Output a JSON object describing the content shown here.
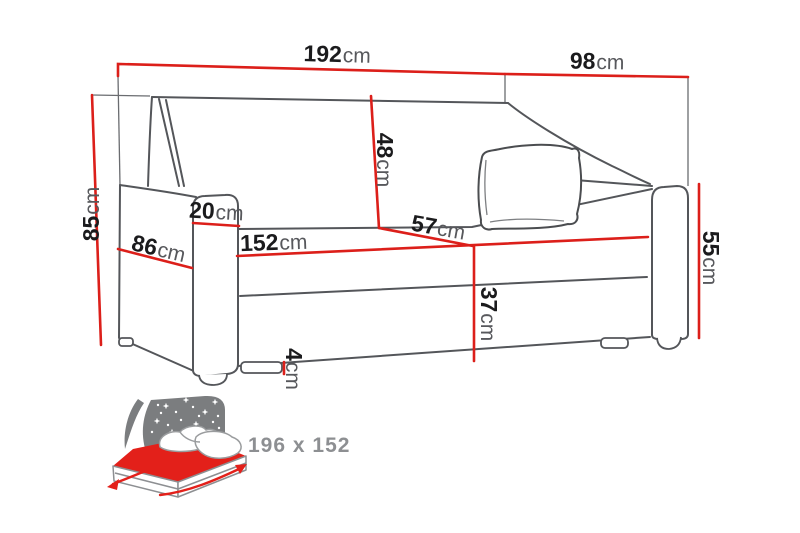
{
  "diagram": {
    "title_hint": "sofa-bed dimension drawing",
    "colors": {
      "dimension_red": "#dc1f1a",
      "outline_gray": "#54565a",
      "number_black": "#1b1b1d",
      "unit_gray": "#57585c",
      "icon_gray": "#7b7d7f",
      "icon_label_gray": "#8d8f92",
      "bed_red": "#e3201a"
    },
    "dims": {
      "width": {
        "value": "192",
        "unit": "cm"
      },
      "depth": {
        "value": "98",
        "unit": "cm"
      },
      "height": {
        "value": "85",
        "unit": "cm"
      },
      "side_depth": {
        "value": "86",
        "unit": "cm"
      },
      "arm_width": {
        "value": "20",
        "unit": "cm"
      },
      "backrest_height": {
        "value": "48",
        "unit": "cm"
      },
      "seat_width": {
        "value": "152",
        "unit": "cm"
      },
      "seat_depth": {
        "value": "57",
        "unit": "cm"
      },
      "arm_height": {
        "value": "55",
        "unit": "cm"
      },
      "seat_height": {
        "value": "37",
        "unit": "cm"
      },
      "leg_height": {
        "value": "4",
        "unit": "cm"
      }
    },
    "sleeping_area": {
      "label": "196 x 152"
    }
  }
}
